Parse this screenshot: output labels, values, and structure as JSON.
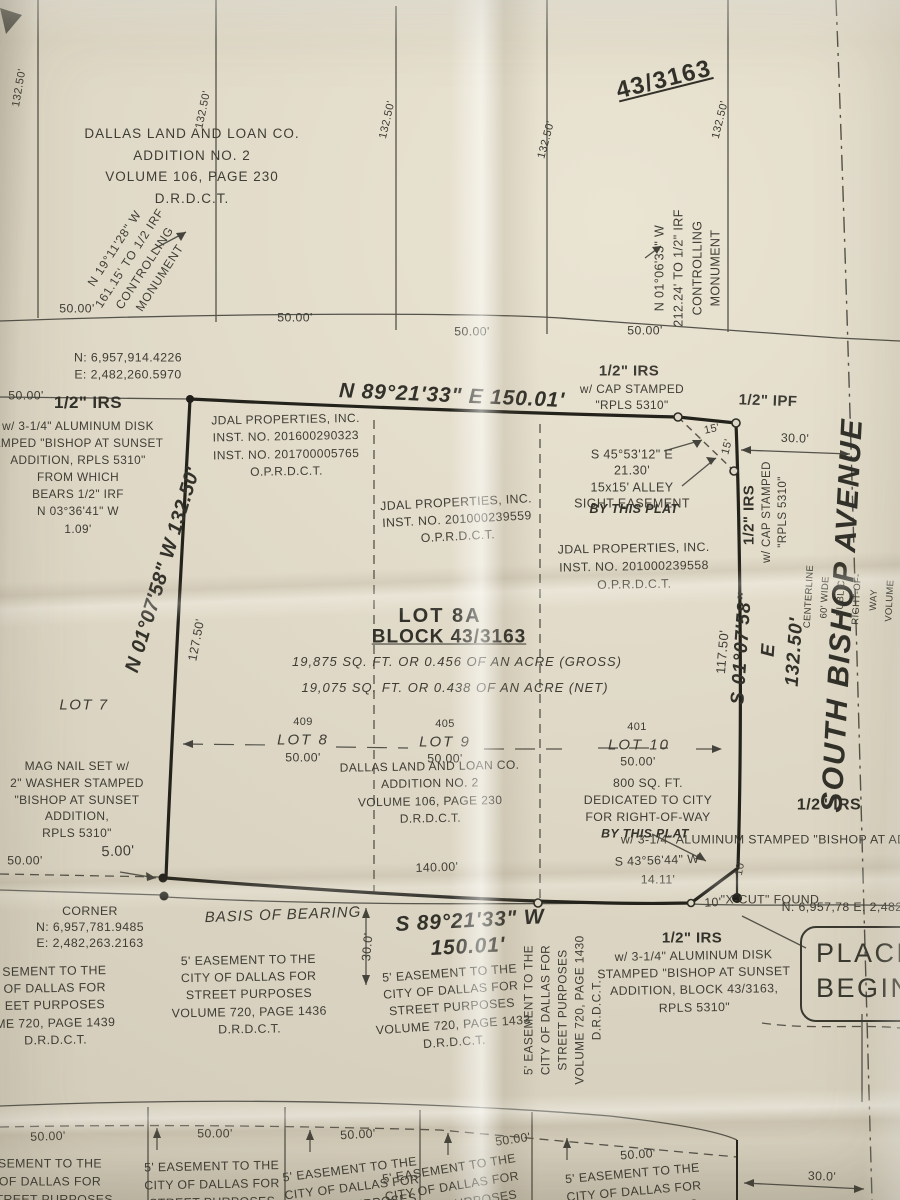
{
  "meta": {
    "description": "Photographed boundary survey plat of Lot 8A, Block 43/3163, Dallas"
  },
  "colors": {
    "paper": "#ded7c5",
    "ink": "#3e3d35",
    "bold_ink": "#23221b"
  },
  "upper_block": {
    "addition": [
      "DALLAS LAND AND LOAN CO.",
      "ADDITION NO. 2",
      "VOLUME 106, PAGE 230",
      "D.R.D.C.T."
    ],
    "block_no": "43/3163",
    "dims_132": [
      "132.50'",
      "132.50'",
      "132.50'",
      "132.50'",
      "132.50'"
    ],
    "dims_50": [
      "50.00'",
      "50.00'",
      "50.00'",
      "50.00'"
    ],
    "nw_monument": [
      "N 19°11'28\" W",
      "161.15' TO 1/2 IRF",
      "CONTROLLING",
      "MONUMENT"
    ],
    "ne_monument": [
      "N 01°06'33\" W",
      "212.24' TO 1/2\" IRF",
      "CONTROLLING",
      "MONUMENT"
    ]
  },
  "north_row": {
    "nw_coords": [
      "N: 6,957,914.4226",
      "E: 2,482,260.5970"
    ],
    "bearing": "N 89°21'33\" E 150.01'",
    "dim_50_west": "50.00'",
    "irs_west_title": "1/2\" IRS",
    "irs_west_sub": [
      "w/ 3-1/4\" ALUMINUM DISK",
      "AMPED \"BISHOP AT SUNSET",
      "ADDITION, RPLS 5310\"",
      "FROM WHICH",
      "BEARS 1/2\" IRF",
      "N 03°36'41\" W",
      "1.09'"
    ],
    "irs_mid_title": "1/2\" IRS",
    "irs_mid_sub": [
      "w/ CAP STAMPED",
      "\"RPLS 5310\""
    ],
    "ipf": "1/2\" IPF"
  },
  "west_side": {
    "bearing": "N 01°07'58\" W 132.50'",
    "dim_127": "127.50'",
    "lot7": "LOT 7",
    "mag_nail": [
      "MAG NAIL SET w/",
      "2\" WASHER STAMPED",
      "\"BISHOP AT SUNSET",
      "ADDITION,",
      "RPLS 5310\""
    ],
    "dim_50": "50.00'",
    "dim_5": "5.00'"
  },
  "parcel": {
    "jdal_nw": [
      "JDAL PROPERTIES, INC.",
      "INST. NO. 201600290323",
      "INST. NO. 201700005765",
      "O.P.R.D.C.T."
    ],
    "jdal_mid": [
      "JDAL PROPERTIES, INC.",
      "INST. NO. 201000239559",
      "O.P.R.D.C.T."
    ],
    "jdal_ne": [
      "JDAL PROPERTIES, INC.",
      "INST. NO. 201000239558",
      "O.P.R.D.C.T."
    ],
    "alley": [
      "S 45°53'12\" E",
      "21.30'",
      "15x15' ALLEY",
      "SIGHT EASEMENT"
    ],
    "alley_bold": "BY THIS PLAT",
    "title_lot": "LOT 8A",
    "title_block": "BLOCK 43/3163",
    "area_gross": "19,875 SQ. FT. OR 0.456 OF AN ACRE (GROSS)",
    "area_net": "19,075 SQ. FT. OR 0.438 OF AN ACRE (NET)",
    "lots": [
      {
        "num": "409",
        "name": "LOT 8",
        "dim": "50.00'"
      },
      {
        "num": "405",
        "name": "LOT 9",
        "dim": "50.00'"
      },
      {
        "num": "401",
        "name": "LOT 10",
        "dim": "50.00'"
      }
    ],
    "addition": [
      "DALLAS LAND AND LOAN CO.",
      "ADDITION NO. 2",
      "VOLUME 106, PAGE 230",
      "D.R.D.C.T."
    ],
    "row_dedication": [
      "800 SQ. FT.",
      "DEDICATED TO CITY",
      "FOR RIGHT-OF-WAY"
    ],
    "row_dedication_bold": "BY THIS PLAT",
    "se_bearing": [
      "S 43°56'44\" W",
      "14.11'"
    ],
    "dim_140": "140.00'",
    "dim_15a": "15'",
    "dim_15b": "15'"
  },
  "east_side": {
    "dim_30_top": "30.0'",
    "irs_cap_title": "1/2\" IRS",
    "irs_cap_sub": [
      "w/ CAP STAMPED",
      "\"RPLS 5310\""
    ],
    "dim_117": "117.50'",
    "bearing": [
      "S 01°07'58\" E",
      "132.50'"
    ],
    "street": "SOUTH BISHOP AVENUE",
    "street_sub": [
      "CENTERLINE 60' WIDE PUBLIC RIGHT-OF-WAY",
      "VOLUME 106, PAGE 230 - D.R.D.C.T."
    ],
    "irs_se_right_title": "1/2\" IRS",
    "irs_se_right_sub": [
      "w/ 3-1/4\" ALUMINUM",
      "STAMPED \"BISHOP AT",
      "ADDITION, BLOCK 43",
      "RPLS 5310\""
    ],
    "se_coords": [
      "N: 6,957,78",
      "E: 2,482,41",
      "CORN"
    ],
    "xcut": [
      "\"X-CUT\"",
      "FOUND"
    ],
    "dim_10v": "10'",
    "dim_10h": "10'",
    "place": [
      "PLACE",
      "BEGIN"
    ]
  },
  "south": {
    "sw_corner": [
      "CORNER",
      "N: 6,957,781.9485",
      "E: 2,482,263.2163"
    ],
    "sw_easement": [
      "SEMENT TO THE",
      "OF DALLAS FOR",
      "EET PURPOSES",
      "ME 720, PAGE 1439",
      "D.R.D.C.T."
    ],
    "basis": "BASIS OF BEARING",
    "easement_1436": [
      "5' EASEMENT TO THE",
      "CITY OF DALLAS FOR",
      "STREET PURPOSES",
      "VOLUME 720, PAGE 1436",
      "D.R.D.C.T."
    ],
    "dim_30": "30.0'",
    "bearing_1": "S 89°21'33\" W",
    "bearing_2": "150.01'",
    "easement_1433": [
      "5' EASEMENT TO THE",
      "CITY OF DALLAS FOR",
      "STREET PURPOSES",
      "VOLUME 720, PAGE 1433",
      "D.R.D.C.T."
    ],
    "easement_1430": [
      "5' EASEMENT TO THE",
      "CITY OF DALLAS FOR",
      "STREET PURPOSES",
      "VOLUME 720, PAGE 1430",
      "D.R.D.C.T."
    ],
    "irs_se_title": "1/2\" IRS",
    "irs_se_sub": [
      "w/ 3-1/4\" ALUMINUM DISK",
      "STAMPED \"BISHOP AT SUNSET",
      "ADDITION, BLOCK 43/3163,",
      "RPLS 5310\""
    ]
  },
  "bottom": {
    "dims_50": [
      "50.00'",
      "50.00'",
      "50.00'",
      "50.00'",
      "50.00'"
    ],
    "easement_cut": [
      "SEMENT TO THE",
      "OF DALLAS FOR",
      "STREET PURPOSES"
    ],
    "easements": [
      [
        "5' EASEMENT TO THE",
        "CITY OF DALLAS FOR",
        "STREET PURPOSES"
      ],
      [
        "5' EASEMENT TO THE",
        "CITY OF DALLAS FOR",
        "STREET PURPOSES"
      ],
      [
        "5' EASEMENT TO THE",
        "CITY OF DALLAS FOR",
        "STREET PURPOSES"
      ],
      [
        "5' EASEMENT TO THE",
        "CITY OF DALLAS FOR",
        "STREET PURPOSES"
      ]
    ],
    "dim_30": "30.0'"
  }
}
